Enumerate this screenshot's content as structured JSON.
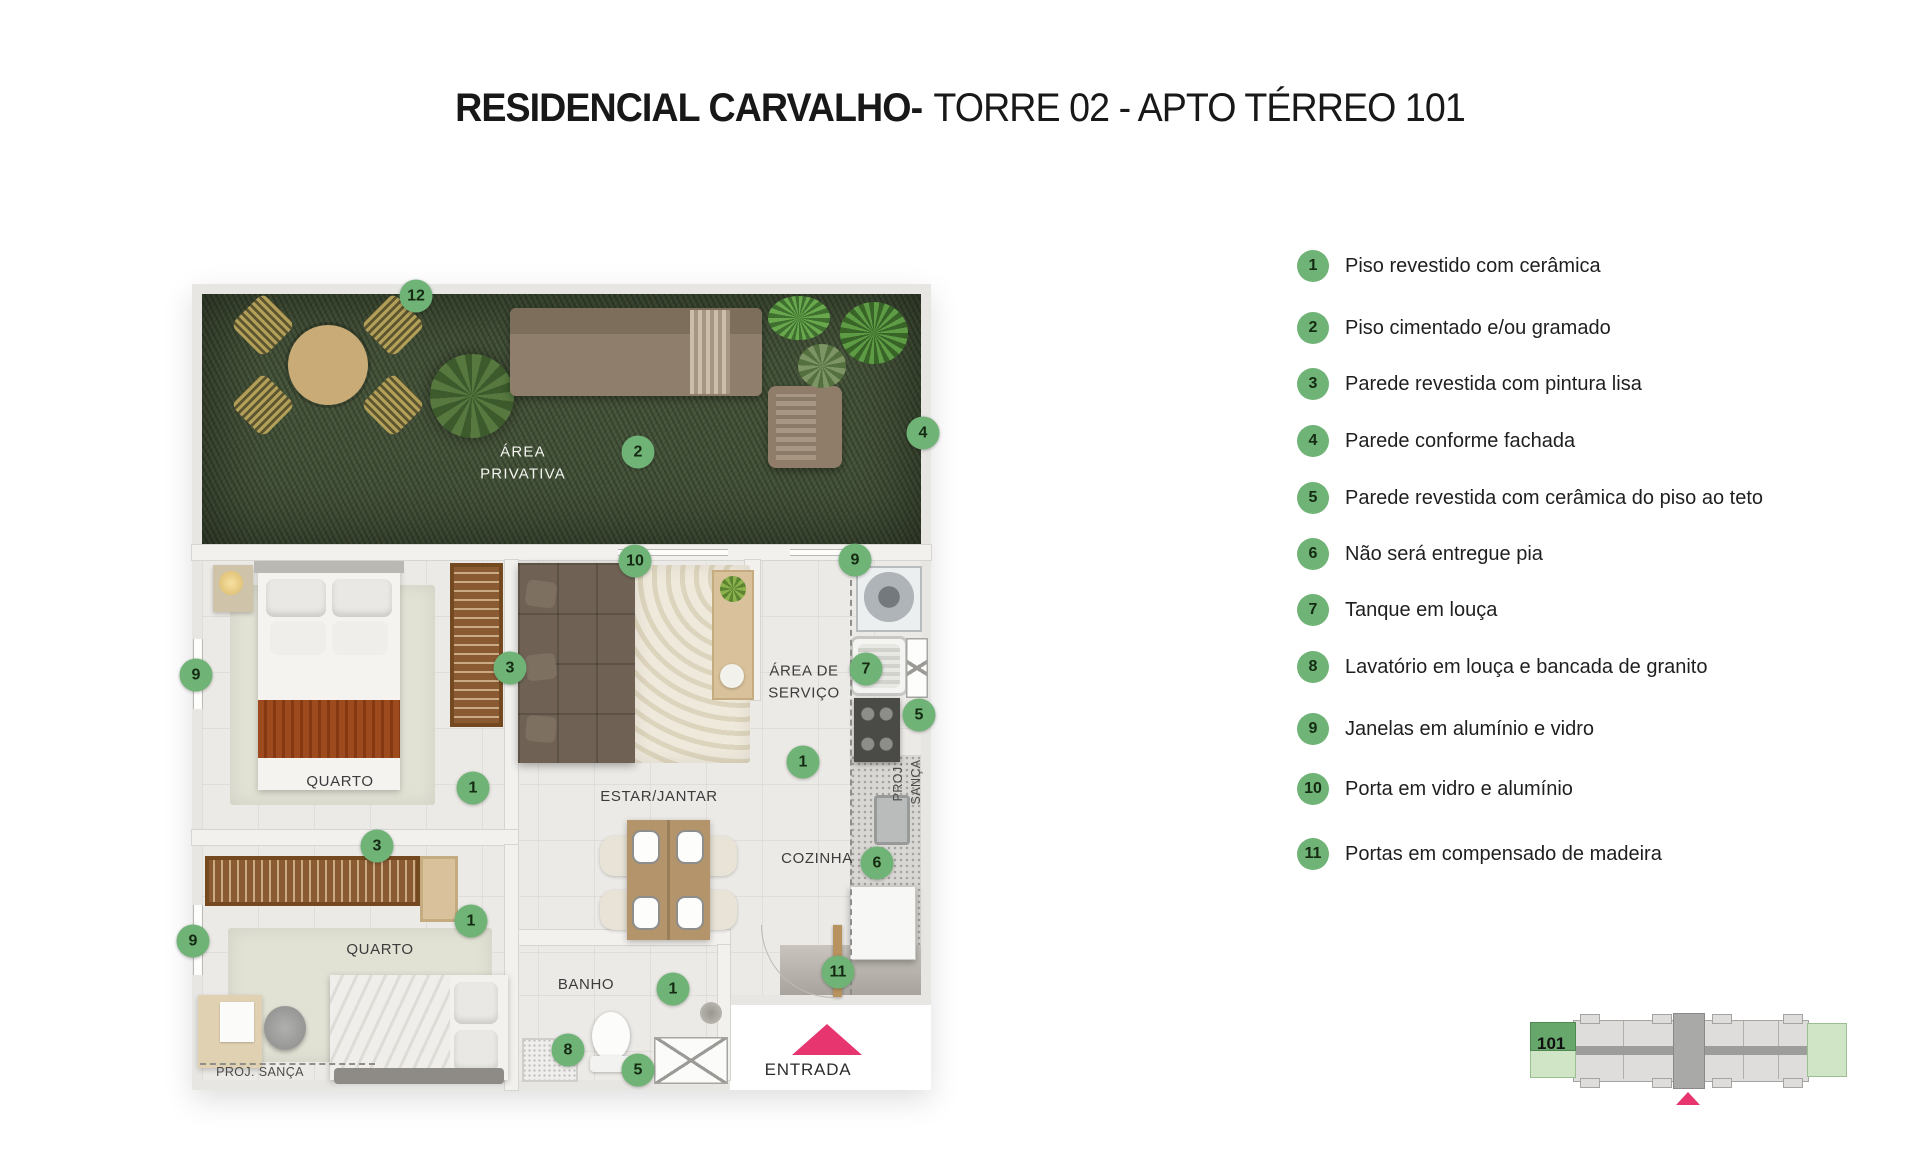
{
  "title": {
    "bold": "RESIDENCIAL CARVALHO-",
    "regular": "TORRE 02 - APTO TÉRREO 101"
  },
  "legend": {
    "items": [
      {
        "num": "1",
        "label": "Piso revestido com cerâmica"
      },
      {
        "num": "2",
        "label": "Piso cimentado e/ou gramado"
      },
      {
        "num": "3",
        "label": "Parede revestida com pintura lisa"
      },
      {
        "num": "4",
        "label": "Parede  conforme fachada"
      },
      {
        "num": "5",
        "label": "Parede revestida com cerâmica do piso ao teto"
      },
      {
        "num": "6",
        "label": "Não será entregue pia"
      },
      {
        "num": "7",
        "label": "Tanque em louça"
      },
      {
        "num": "8",
        "label": "Lavatório em louça e bancada de granito"
      },
      {
        "num": "9",
        "label": "Janelas em alumínio e vidro"
      },
      {
        "num": "10",
        "label": "Porta em vidro e alumínio"
      },
      {
        "num": "11",
        "label": "Portas em compensado de madeira"
      }
    ]
  },
  "plan": {
    "markers": [
      {
        "num": "12"
      },
      {
        "num": "2"
      },
      {
        "num": "4"
      },
      {
        "num": "10"
      },
      {
        "num": "9"
      },
      {
        "num": "3"
      },
      {
        "num": "7"
      },
      {
        "num": "5"
      },
      {
        "num": "9"
      },
      {
        "num": "1"
      },
      {
        "num": "1"
      },
      {
        "num": "3"
      },
      {
        "num": "6"
      },
      {
        "num": "1"
      },
      {
        "num": "9"
      },
      {
        "num": "11"
      },
      {
        "num": "1"
      },
      {
        "num": "8"
      },
      {
        "num": "5"
      }
    ],
    "labels": {
      "area_privativa": "ÁREA\nPRIVATIVA",
      "quarto1": "QUARTO",
      "estar_jantar": "ESTAR/JANTAR",
      "area_servico": "ÁREA DE\nSERVIÇO",
      "cozinha": "COZINHA",
      "quarto2": "QUARTO",
      "banho": "BANHO",
      "proj_sanca_right": "PROJ. SANÇA",
      "proj_sanca_bottom": "PROJ. SANÇA",
      "entrada": "ENTRADA"
    }
  },
  "keymap": {
    "unit_label": "101"
  },
  "colors": {
    "marker_green": "#6fb376",
    "entry_pink": "#e73570",
    "garden_green": "#45523a",
    "legend_text": "#1f1f1f"
  }
}
